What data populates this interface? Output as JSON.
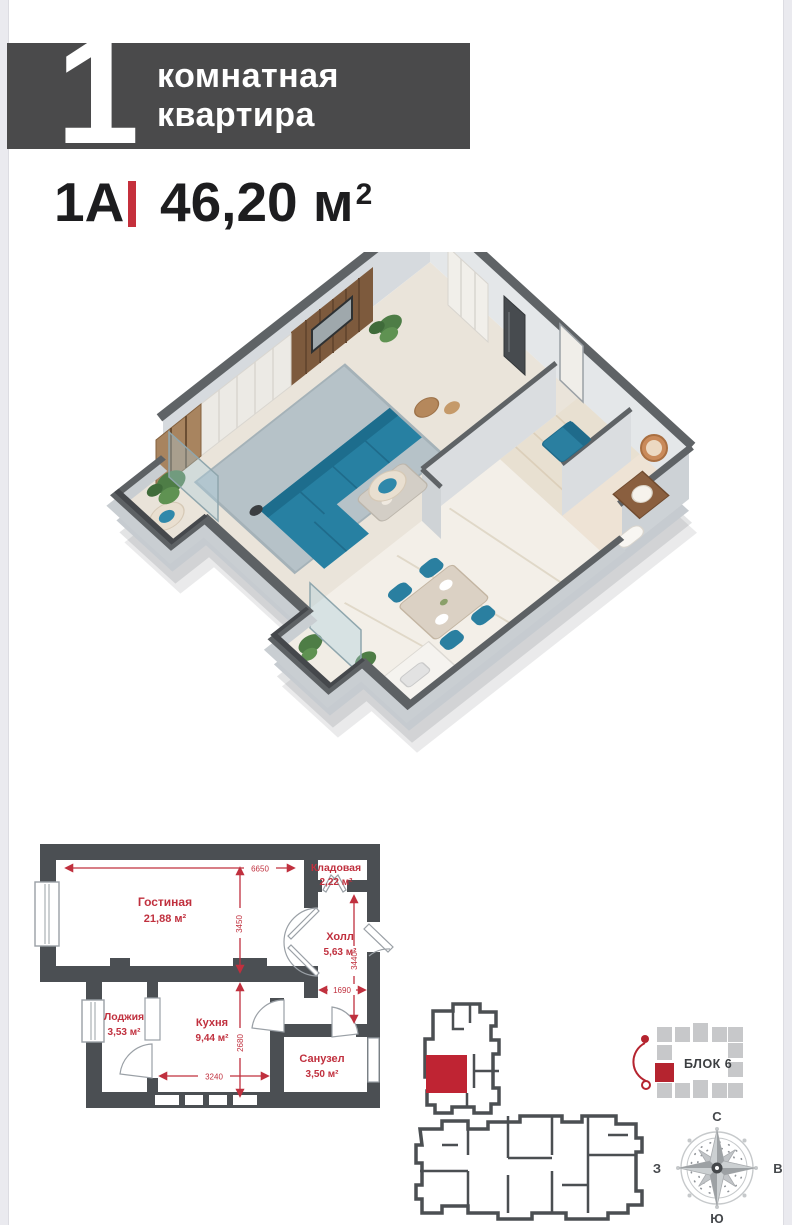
{
  "header": {
    "big_number": "1",
    "title_line1": "комнатная",
    "title_line2": "квартира"
  },
  "unit": {
    "code": "1A",
    "area": "46,20",
    "area_unit": "м",
    "area_exp": "2"
  },
  "floor_plan": {
    "rooms": [
      {
        "name": "Гостиная",
        "area": "21,88 м²"
      },
      {
        "name": "Кладовая",
        "area": "2,22 м²"
      },
      {
        "name": "Холл",
        "area": "5,63 м²"
      },
      {
        "name": "Лоджия",
        "area": "3,53 м²"
      },
      {
        "name": "Кухня",
        "area": "9,44 м²"
      },
      {
        "name": "Санузел",
        "area": "3,50 м²"
      }
    ],
    "dimensions": {
      "top_width": "6650",
      "living_depth": "3450",
      "hall_depth": "3440",
      "hall_width": "1690",
      "kitchen_depth": "2680",
      "kitchen_width": "3240"
    }
  },
  "block": {
    "label": "БЛОК 6"
  },
  "compass": {
    "n": "С",
    "s": "Ю",
    "w": "З",
    "e": "В"
  },
  "colors": {
    "accent": "#c5303c",
    "wall": "#4b4f53",
    "banner": "#4a4a4b",
    "teal": "#2780a2"
  }
}
